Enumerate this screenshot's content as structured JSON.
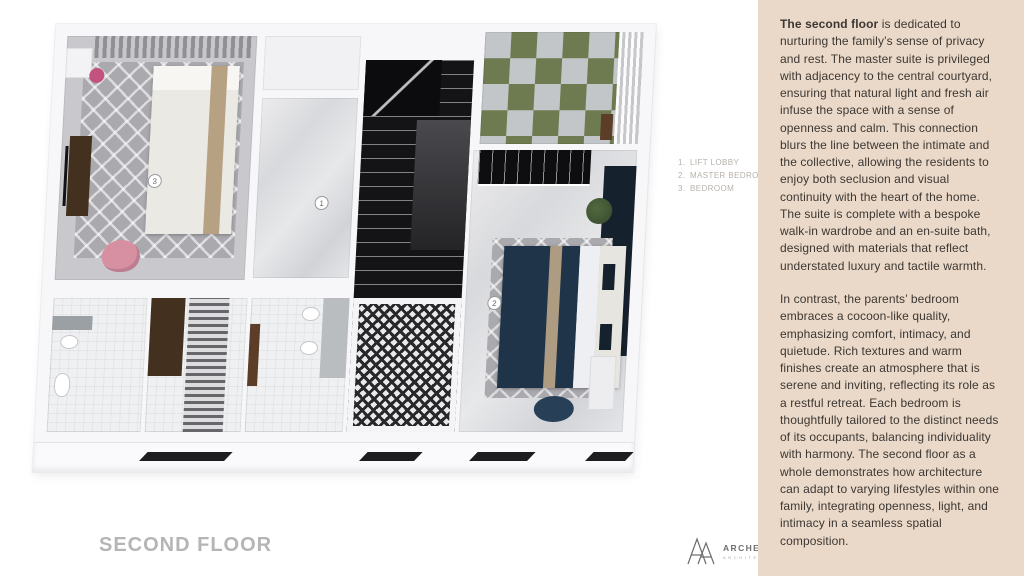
{
  "panel": {
    "p1_bold": "The second floor",
    "p1_rest": " is dedicated to nurturing the family’s sense of privacy and rest. The master suite is privileged with adjacency to the central courtyard, ensuring that natural light and fresh air infuse the space with a sense of openness and calm. This connection blurs the line between the intimate and the collective, allowing the residents to enjoy both seclusion and visual continuity with the heart of the home. The suite is complete with a bespoke walk-in wardrobe and an en-suite bath, designed with materials that reflect understated luxury and tactile warmth.",
    "p2": "In contrast, the parents’ bedroom embraces a cocoon-like quality, emphasizing comfort, intimacy, and quietude. Rich textures and warm finishes create an atmosphere that is serene and inviting, reflecting its role as a restful retreat. Each bedroom is thoughtfully tailored to the distinct needs of its occupants, balancing individuality with harmony. The second floor as a whole demonstrates how architecture can adapt to varying lifestyles within one family, integrating openness, light, and intimacy in a seamless spatial composition."
  },
  "plan": {
    "title": "SECOND FLOOR",
    "markers": [
      "1",
      "2",
      "3"
    ],
    "legend": {
      "items": [
        {
          "num": "1.",
          "label": "LIFT LOBBY"
        },
        {
          "num": "2.",
          "label": "MASTER BEDROOM"
        },
        {
          "num": "3.",
          "label": "BEDROOM"
        }
      ]
    }
  },
  "logo": {
    "name": "ARCHEMIST",
    "sub": "ARCHITECTS"
  },
  "colors": {
    "panel_bg": "#ead9c8",
    "panel_text": "#3c3733",
    "terrace_green": "#6e7b50",
    "terrace_gray": "#c3c6c9",
    "master_bed_navy": "#1f3449",
    "accent_wall_navy": "#16212e",
    "bedroom_chair_pink": "#d78fa2",
    "stool_pink": "#c2527e",
    "wood_brown": "#43301f",
    "title_gray": "#b5b5b5",
    "legend_gray": "#b7b1aa"
  }
}
